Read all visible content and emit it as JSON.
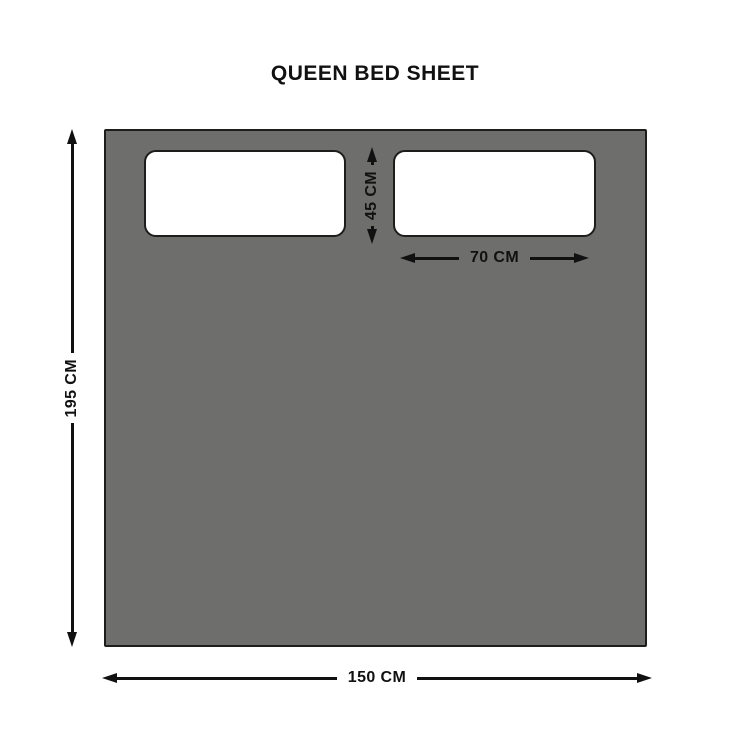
{
  "title": "QUEEN BED SHEET",
  "diagram": {
    "dimensions": {
      "sheet_height": {
        "label": "195 CM"
      },
      "sheet_width": {
        "label": "150 CM"
      },
      "pillow_width": {
        "label": "70 CM"
      },
      "pillow_height": {
        "label": "45 CM"
      }
    },
    "colors": {
      "background": "#ffffff",
      "sheet_fill": "#6e6f6d",
      "outline": "#1d1d1b",
      "pillow_fill": "#ffffff",
      "arrow": "#111111",
      "text": "#111111"
    }
  }
}
